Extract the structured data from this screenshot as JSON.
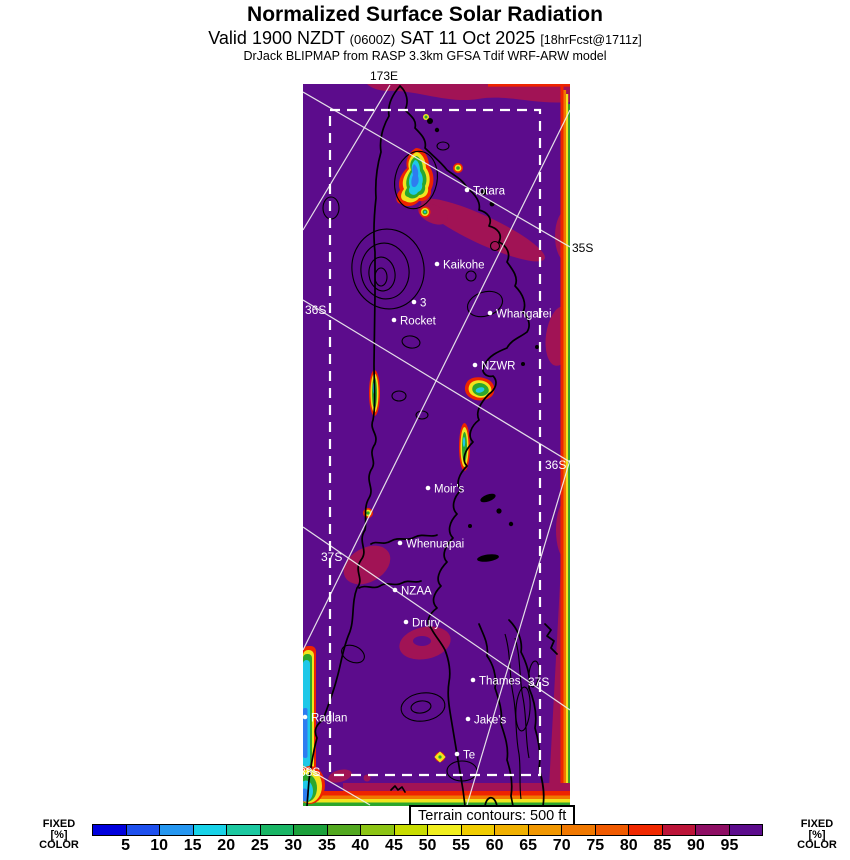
{
  "header": {
    "title": "Normalized Surface Solar Radiation",
    "valid": "Valid 1900 NZDT",
    "valid_zulu": "(0600Z)",
    "valid_date": "SAT 11 Oct 2025",
    "forecast_tag": "[18hrFcst@1711z]",
    "model_line": "DrJack BLIPMAP from RASP 3.3km GFSA Tdif WRF-ARW model"
  },
  "map": {
    "graticule_labels": [
      {
        "text": "173E",
        "x": 101,
        "y": 16,
        "color": "#000000",
        "anchor": "middle"
      },
      {
        "text": "35S",
        "x": 289,
        "y": 188,
        "color": "#000000",
        "anchor": "start"
      },
      {
        "text": "36S",
        "x": 22,
        "y": 250,
        "color": "#ffffff",
        "anchor": "start"
      },
      {
        "text": "36S",
        "x": 262,
        "y": 405,
        "color": "#ffffff",
        "anchor": "start"
      },
      {
        "text": "37S",
        "x": 38,
        "y": 497,
        "color": "#ffffff",
        "anchor": "start"
      },
      {
        "text": "37S",
        "x": 245,
        "y": 622,
        "color": "#ffffff",
        "anchor": "start"
      },
      {
        "text": "38S",
        "x": 16,
        "y": 712,
        "color": "#ffffff",
        "anchor": "start"
      }
    ],
    "places": [
      {
        "name": "Totara",
        "x": 184,
        "y": 126
      },
      {
        "name": "Kaikohe",
        "x": 154,
        "y": 200
      },
      {
        "name": "3",
        "x": 131,
        "y": 238
      },
      {
        "name": "Rocket",
        "x": 111,
        "y": 256
      },
      {
        "name": "Whangarei",
        "x": 207,
        "y": 249
      },
      {
        "name": "NZWR",
        "x": 192,
        "y": 301
      },
      {
        "name": "Moir's",
        "x": 145,
        "y": 424
      },
      {
        "name": "Whenuapai",
        "x": 117,
        "y": 479
      },
      {
        "name": "NZAA",
        "x": 112,
        "y": 526
      },
      {
        "name": "Drury",
        "x": 123,
        "y": 558
      },
      {
        "name": "Thames",
        "x": 190,
        "y": 616
      },
      {
        "name": "Jake's",
        "x": 185,
        "y": 655
      },
      {
        "name": "Te",
        "x": 174,
        "y": 690
      },
      {
        "name": "Raglan",
        "x": 22,
        "y": 653
      }
    ]
  },
  "terrain_note": "Terrain contours: 500 ft",
  "colorbar": {
    "side_label_lines": [
      "FIXED",
      "[%]",
      "COLOR"
    ],
    "unit": "%",
    "ticks": [
      5,
      10,
      15,
      20,
      25,
      30,
      35,
      40,
      45,
      50,
      55,
      60,
      65,
      70,
      75,
      80,
      85,
      90,
      95
    ],
    "colors": [
      "#0000dd",
      "#1e50ee",
      "#2596f0",
      "#18d2e8",
      "#1cc8a0",
      "#19b565",
      "#1ba03b",
      "#52a81f",
      "#8cc414",
      "#c8dc00",
      "#f0ee1e",
      "#f0cc00",
      "#f0b000",
      "#f09600",
      "#f07800",
      "#f05a00",
      "#f02800",
      "#bc1438",
      "#8e0e64",
      "#5c0c8c"
    ]
  },
  "map_colors": {
    "background": "#5c0c8c",
    "crimson_patch": "#a11355",
    "hotspot_red": "#ee2400",
    "hotspot_yellow": "#f0e41e",
    "hotspot_green": "#2ca62c",
    "hotspot_cyan": "#1ec8e8",
    "hotspot_blue": "#2e7cf0"
  }
}
